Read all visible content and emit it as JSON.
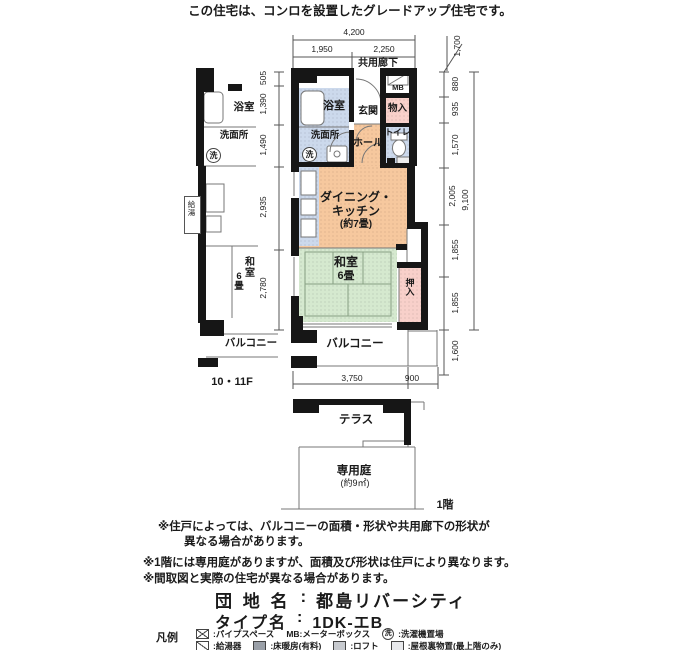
{
  "header": {
    "notice": "この住宅は、コンロを設置したグレードアップ住宅です。"
  },
  "plan": {
    "corridor": "共用廊下",
    "mb": "MB",
    "bathroom": "浴室",
    "washroom": "洗面所",
    "laundry_mark": "洗",
    "entrance": "玄関",
    "storage": "物入",
    "toilet": "トイレ",
    "hall": "ホール",
    "dk1": "ダイニング・",
    "dk2": "キッチン",
    "dk3": "(約7畳)",
    "washitsu1": "和室",
    "washitsu2": "6畳",
    "closet": "押入",
    "balcony": "バルコニー"
  },
  "dims": {
    "total_width": "4,200",
    "width_left": "1,950",
    "width_right": "2,250",
    "corridor_width": "1,700",
    "left_col": [
      "505",
      "1,390",
      "1,490",
      "2,935",
      "2,780"
    ],
    "right_col": [
      "880",
      "935",
      "1,570",
      "2,005",
      "1,855",
      "1,855"
    ],
    "total_height": "9,100",
    "balcony_height": "1,600",
    "balcony_width": "3,750",
    "balcony_ext": "900"
  },
  "left_plan": {
    "bathroom": "浴室",
    "washroom": "洗面所",
    "laundry_mark": "洗",
    "heater": "給湯",
    "washitsu1": "和室",
    "washitsu2": "6畳",
    "balcony": "バルコニー",
    "floors": "10・11F"
  },
  "ground": {
    "terrace": "テラス",
    "garden": "専用庭",
    "garden_size": "(約9㎡)",
    "floor": "1階"
  },
  "notes": {
    "n1a": "※住戸によっては、バルコニーの面積・形状や共用廊下の形状が",
    "n1b": "異なる場合があります。",
    "n2": "※1階には専用庭がありますが、面積及び形状は住戸により異なります。",
    "n3": "※間取図と実際の住宅が異なる場合があります。"
  },
  "property": {
    "estate_label": "団 地 名",
    "colon": ":",
    "estate_name": "都島リバーシティ",
    "type_label": "タイプ名",
    "type_name": "1DK-エB"
  },
  "legend": {
    "title": "凡例",
    "pipe_space": ":パイプスペース",
    "mb_label": "MB:メーターボックス",
    "laundry_mark": "洗",
    "laundry": ":洗濯機置場",
    "heater": ":給湯器",
    "floor_heating": ":床暖房(有料)",
    "loft": ":ロフト",
    "attic": ":屋根裏物置(最上階のみ)"
  },
  "colors": {
    "room_blue": "#ccd9ec",
    "room_pink": "#f8d0ca",
    "room_orange": "#f6c89e",
    "room_green": "#d5e9cf",
    "wall": "#161616"
  }
}
